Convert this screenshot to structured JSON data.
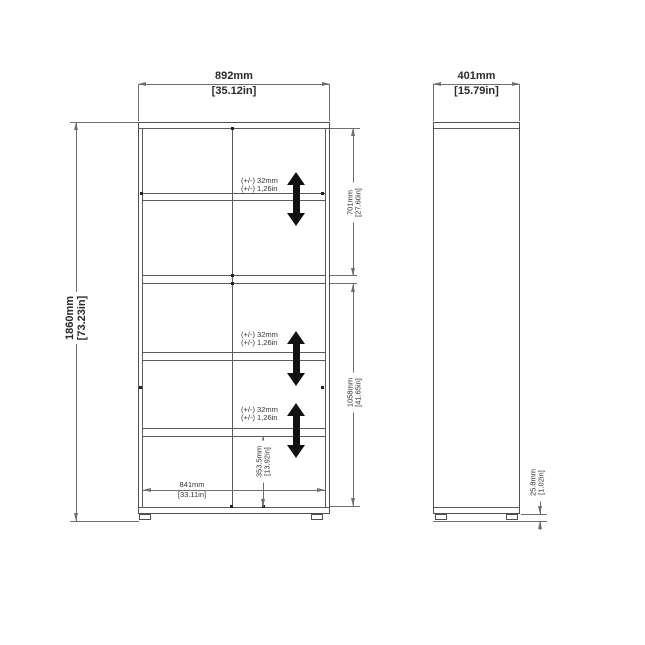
{
  "drawing": {
    "front_view": {
      "width": {
        "metric": "892mm",
        "imperial": "[35.12in]"
      },
      "height": {
        "metric": "1860mm",
        "imperial": "[73.23in]"
      },
      "top_section": {
        "metric": "701mm",
        "imperial": "[27.60in]"
      },
      "bottom_section": {
        "metric": "1058mm",
        "imperial": "[41.65in]"
      },
      "lowest_shelf_height": {
        "metric": "353.5mm",
        "imperial": "[13.92in]"
      },
      "interior_width": {
        "metric": "841mm",
        "imperial": "[33.11in]"
      },
      "shelf_adjustment": [
        {
          "metric": "(+/-) 32mm",
          "imperial": "(+/-) 1,26in"
        },
        {
          "metric": "(+/-) 32mm",
          "imperial": "(+/-) 1,26in"
        },
        {
          "metric": "(+/-) 32mm",
          "imperial": "(+/-) 1,26in"
        }
      ]
    },
    "side_view": {
      "depth": {
        "metric": "401mm",
        "imperial": "[15.79in]"
      },
      "foot_height": {
        "metric": "25.8mm",
        "imperial": "[1.02in]"
      }
    },
    "colors": {
      "background": "#ffffff",
      "cabinet_line": "#4f4f4f",
      "dimension_line": "#6f6f6f",
      "text": "#2a2a2a",
      "arrow": "#111111"
    }
  }
}
